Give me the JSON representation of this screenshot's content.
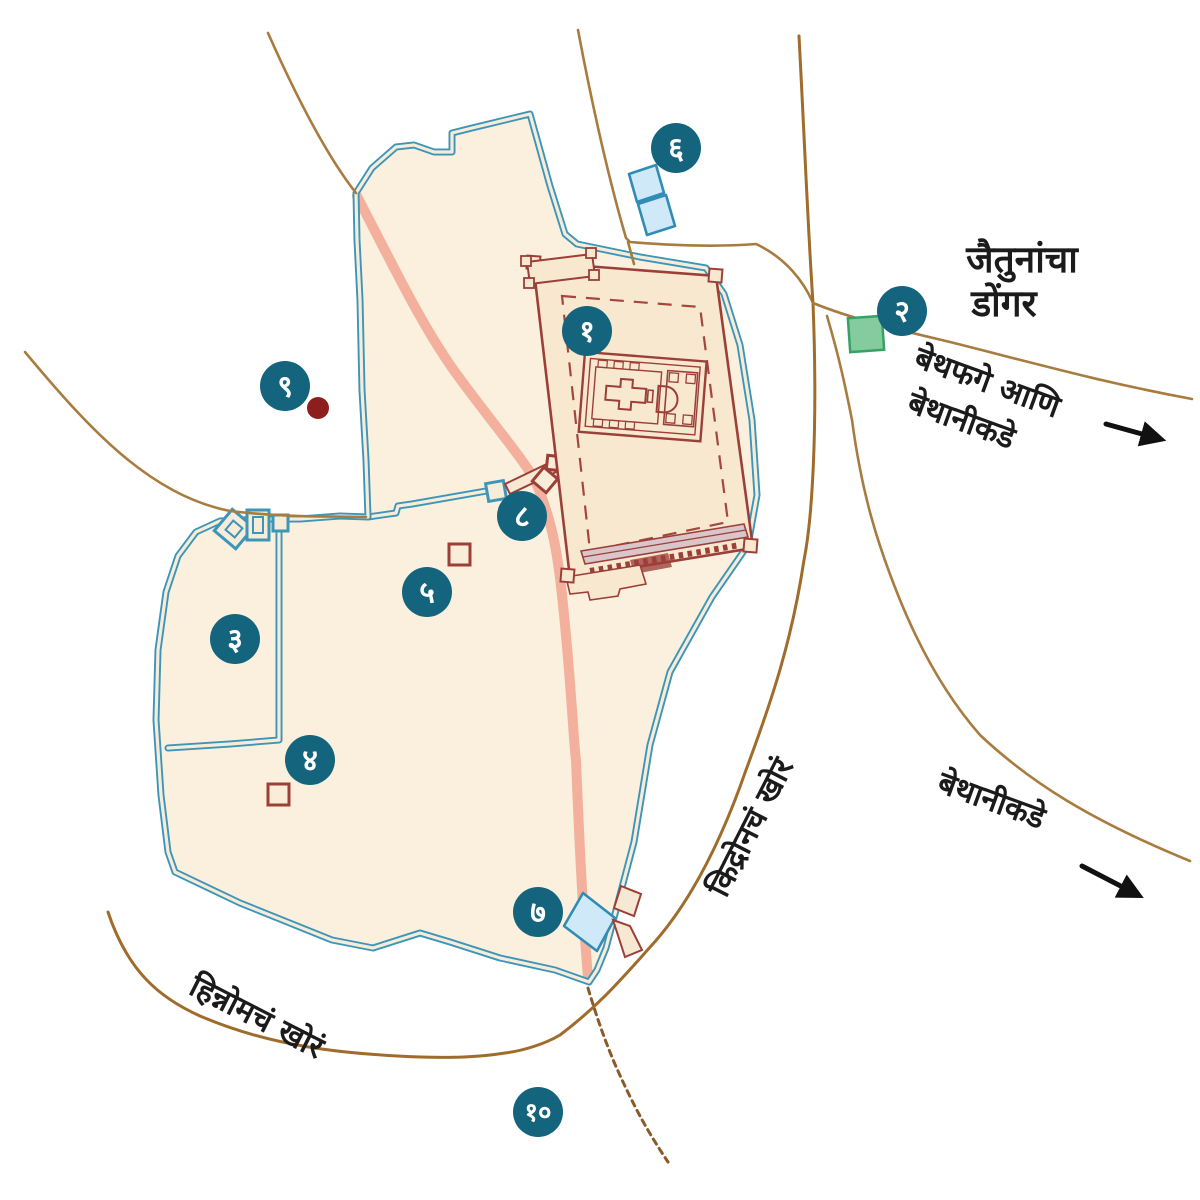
{
  "labels": {
    "mount_of_olives": {
      "line1": "जैतुनांचा",
      "line2": "डोंगर"
    },
    "to_bethphage_and_bethany": {
      "line1": "बेथफगे आणि",
      "line2": "बेथानीकडे"
    },
    "to_bethany": {
      "line1": "बेथानीकडे"
    },
    "kidron_valley": {
      "line1": "किद्रोनचं खोरं"
    },
    "hinnom_valley": {
      "line1": "हिन्नोमचं खोरं"
    }
  },
  "markers": [
    {
      "numeral": "१"
    },
    {
      "numeral": "२"
    },
    {
      "numeral": "३"
    },
    {
      "numeral": "४"
    },
    {
      "numeral": "५"
    },
    {
      "numeral": "६"
    },
    {
      "numeral": "७"
    },
    {
      "numeral": "८"
    },
    {
      "numeral": "९"
    },
    {
      "numeral": "१०"
    }
  ],
  "colors": {
    "marker_circle": "#15647e",
    "marker_text": "#ffffff",
    "city_wall": "#3d95b8",
    "city_fill": "#faf0dd",
    "temple_outline": "#9c3f38",
    "road": "#a87b3e",
    "processional_road": "#f3b19d",
    "water_pool": "#cfe9f8",
    "pool_outline": "#2f8cb5",
    "garden_square": "#84cb9e",
    "red_dot": "#8e1e1e",
    "label_text": "#1b1b1b"
  }
}
